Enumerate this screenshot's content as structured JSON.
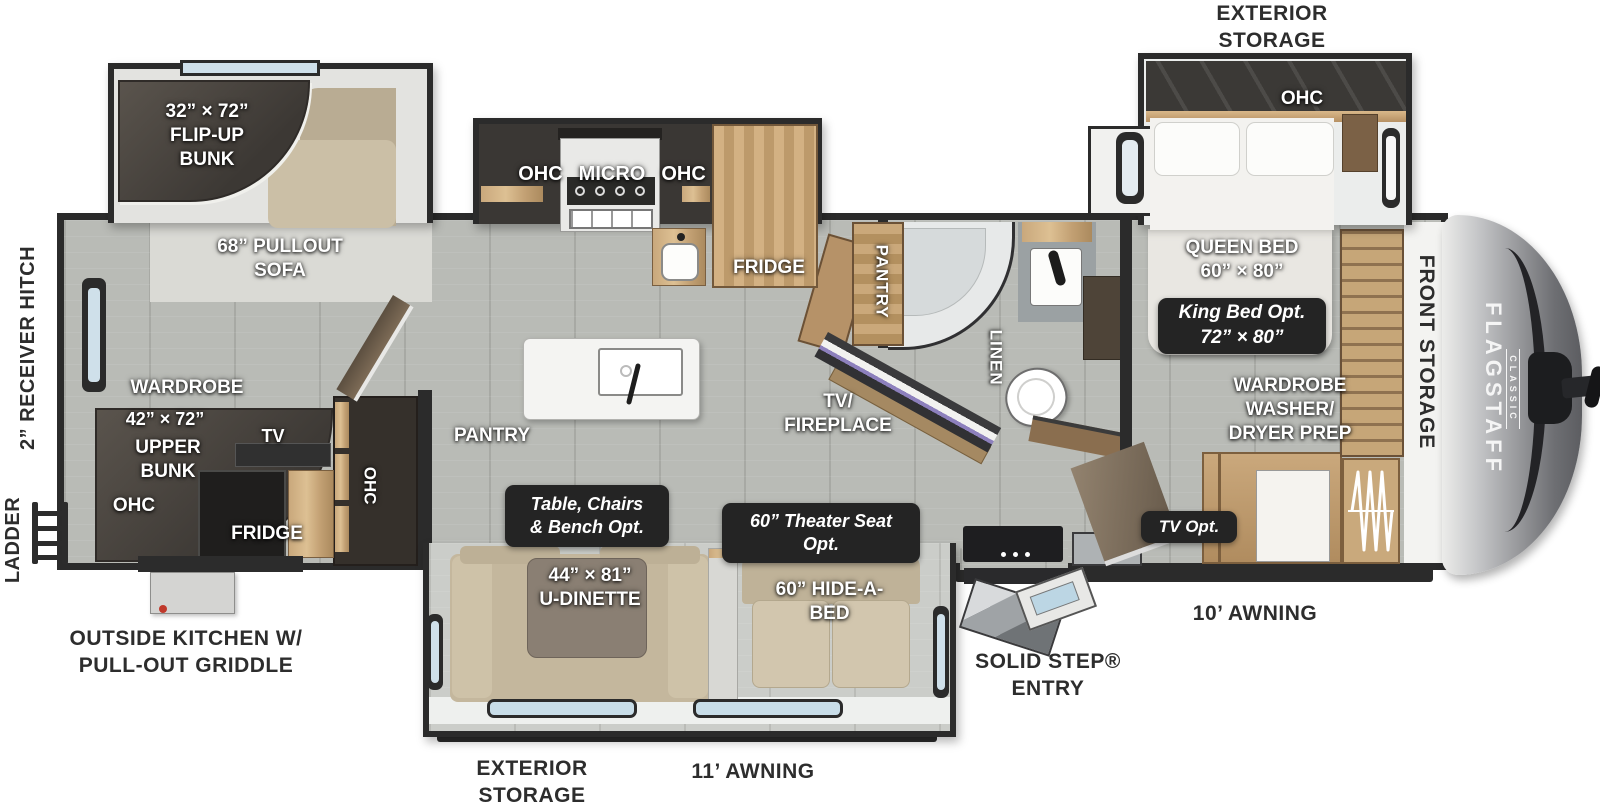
{
  "brand": {
    "name": "FLAGSTAFF",
    "series": "CLASSIC"
  },
  "exterior": {
    "exterior_storage_top": "EXTERIOR\nSTORAGE",
    "exterior_storage_bottom": "EXTERIOR\nSTORAGE",
    "awning_11": "11’ AWNING",
    "awning_10": "10’ AWNING",
    "solid_step_entry": "SOLID STEP®\nENTRY",
    "outside_kitchen": "OUTSIDE KITCHEN W/\nPULL-OUT GRIDDLE",
    "ladder": "LADDER",
    "receiver_hitch": "2” RECEIVER HITCH",
    "front_storage": "FRONT STORAGE"
  },
  "rear_bunk_room": {
    "flip_up_bunk": "32” × 72”\nFLIP-UP\nBUNK",
    "pullout_sofa": "68” PULLOUT\nSOFA",
    "wardrobe": "WARDROBE",
    "upper_bunk_size": "42” × 72”",
    "upper_bunk": "UPPER\nBUNK",
    "ohc_bottom": "OHC",
    "tv": "TV",
    "fridge": "FRIDGE",
    "ohc_side": "OHC"
  },
  "kitchen": {
    "ohc_left": "OHC",
    "micro": "MICRO",
    "ohc_right": "OHC",
    "fridge": "FRIDGE",
    "pantry": "PANTRY"
  },
  "living": {
    "tv_fireplace": "TV/\nFIREPLACE",
    "u_dinette": "44” × 81”\nU-DINETTE",
    "hide_a_bed": "60” HIDE-A-\nBED"
  },
  "options": {
    "table_chairs": "Table, Chairs\n& Bench  Opt.",
    "theater_seat": "60” Theater Seat\nOpt.",
    "king_bed": "King Bed Opt.\n72” × 80”",
    "tv_opt": "TV Opt."
  },
  "bathroom": {
    "pantry": "PANTRY",
    "linen": "LINEN"
  },
  "bedroom": {
    "ohc": "OHC",
    "queen_bed": "QUEEN BED\n60” × 80”",
    "wardrobe_washer_dryer": "WARDROBE\nWASHER/\nDRYER PREP"
  }
}
